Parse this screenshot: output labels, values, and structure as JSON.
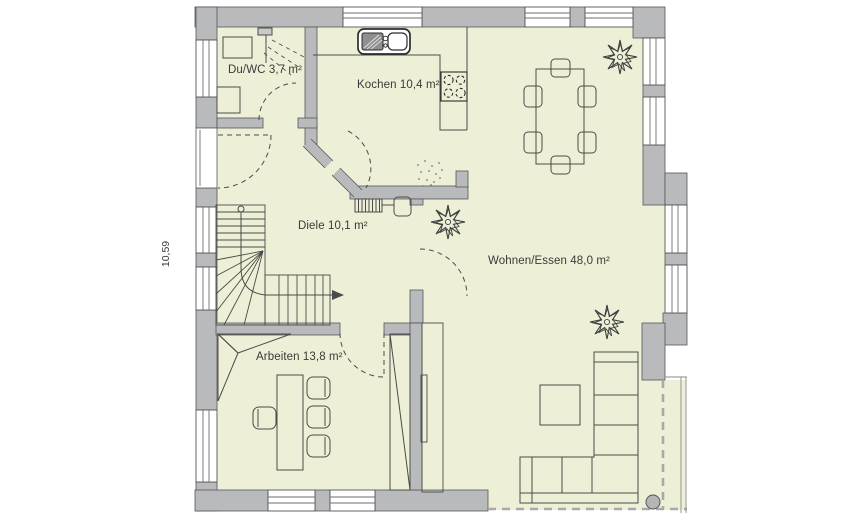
{
  "plan": {
    "title": "ground-floor-plan",
    "rooms": [
      {
        "name": "shower-wc",
        "label": "Du/WC 3,7 m²"
      },
      {
        "name": "kitchen",
        "label": "Kochen 10,4 m²"
      },
      {
        "name": "hallway",
        "label": "Diele 10,1 m²"
      },
      {
        "name": "living-dining",
        "label": "Wohnen/Essen 48,0 m²"
      },
      {
        "name": "office",
        "label": "Arbeiten 13,8 m²"
      }
    ],
    "dimensions": {
      "left_height": "10,59"
    },
    "colors": {
      "floor": "#edf0d6",
      "wall": "#b9babc",
      "wall_outline": "#54555a",
      "furniture_line": "#4b4b4b",
      "text": "#3a3a3a",
      "overhang_dash": "#a9a9a9"
    },
    "features": [
      "staircase",
      "entrance-door",
      "shower",
      "washbasin",
      "wc",
      "kitchen-counter",
      "sink",
      "cooktop",
      "radiator",
      "dining-table",
      "dining-chairs",
      "plants",
      "l-sofa",
      "coffee-table",
      "desk",
      "desk-chairs",
      "wardrobe",
      "corner-cabinet",
      "sideboard",
      "terrace",
      "terrace-column"
    ]
  }
}
